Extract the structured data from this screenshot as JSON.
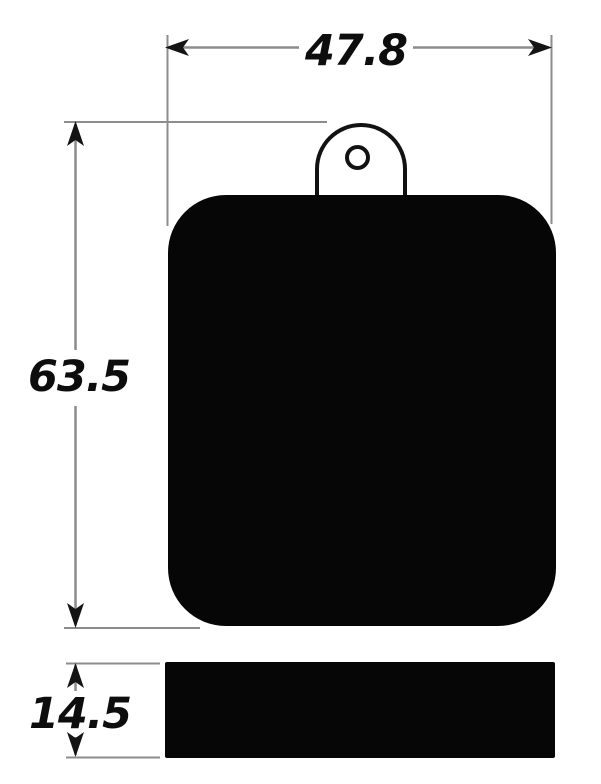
{
  "drawing": {
    "type": "technical-dimension-drawing",
    "background": "#ffffff",
    "colors": {
      "shape_fill": "#060606",
      "outline": "#121212",
      "dimension_line": "#8c8c8c",
      "arrowhead": "#141414",
      "label_text": "#0d0d0d"
    },
    "views": {
      "front": "pad front profile with mounting tab and hole",
      "side": "pad thickness profile"
    },
    "dimensions": {
      "width": {
        "label": "47.8",
        "orientation": "horizontal",
        "applies_to": "front view overall width"
      },
      "height": {
        "label": "63.5",
        "orientation": "vertical",
        "applies_to": "front view overall height including tab"
      },
      "thickness": {
        "label": "14.5",
        "orientation": "vertical",
        "applies_to": "side view thickness"
      }
    }
  }
}
